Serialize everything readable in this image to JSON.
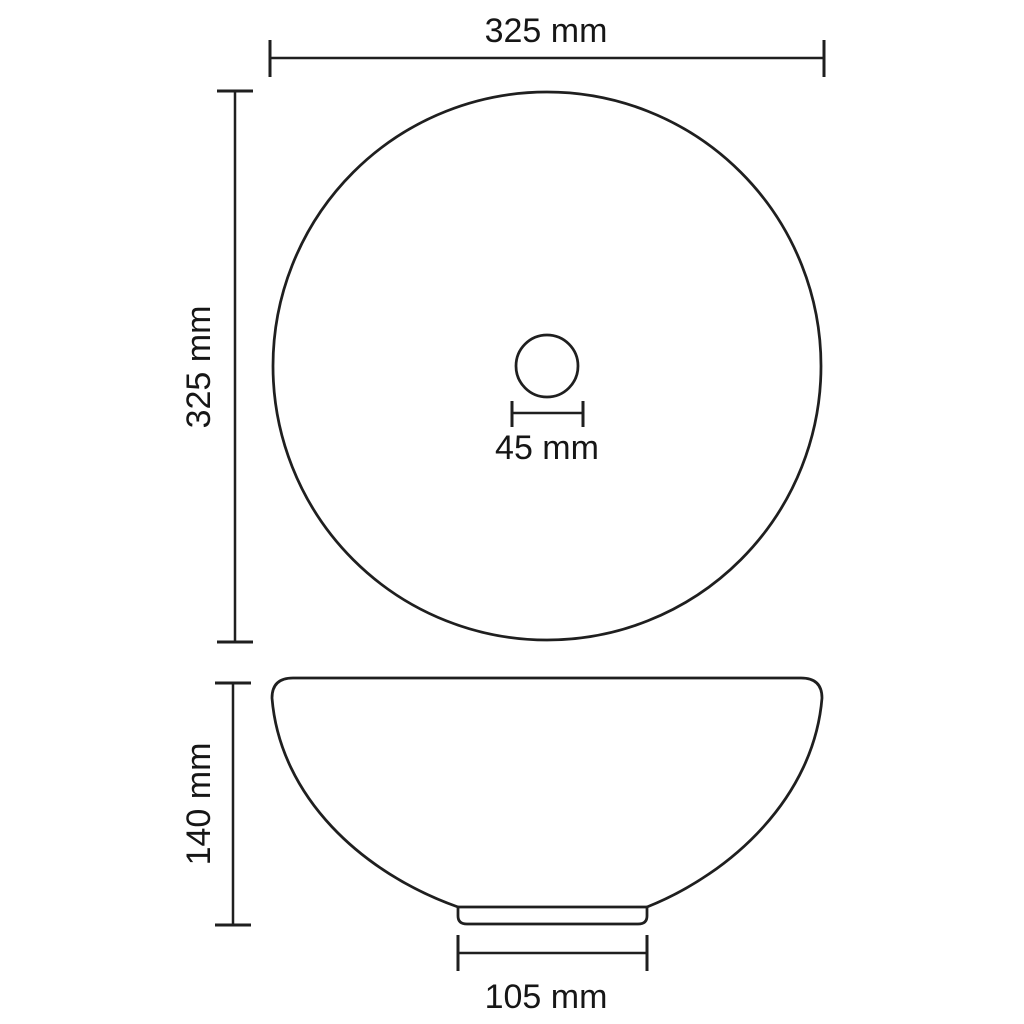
{
  "diagram": {
    "title": "Round washbasin dimension drawing",
    "background_color": "#ffffff",
    "line_color": "#1f1f1f",
    "text_color": "#161616",
    "views": [
      {
        "id": "top-view",
        "description": "circular basin seen from above with centered drain hole"
      },
      {
        "id": "side-view",
        "description": "bowl profile with small pedestal base"
      }
    ],
    "dimensions": {
      "top_width": {
        "label": "325 mm",
        "orientation": "horizontal",
        "measures": "outer diameter (width), top view"
      },
      "left_height": {
        "label": "325 mm",
        "orientation": "vertical",
        "measures": "outer diameter (height), top view"
      },
      "drain_diameter": {
        "label": "45 mm",
        "orientation": "horizontal",
        "measures": "drain hole diameter"
      },
      "side_height": {
        "label": "140 mm",
        "orientation": "vertical",
        "measures": "basin height, side view"
      },
      "base_width": {
        "label": "105 mm",
        "orientation": "horizontal",
        "measures": "pedestal base width, side view"
      }
    }
  }
}
